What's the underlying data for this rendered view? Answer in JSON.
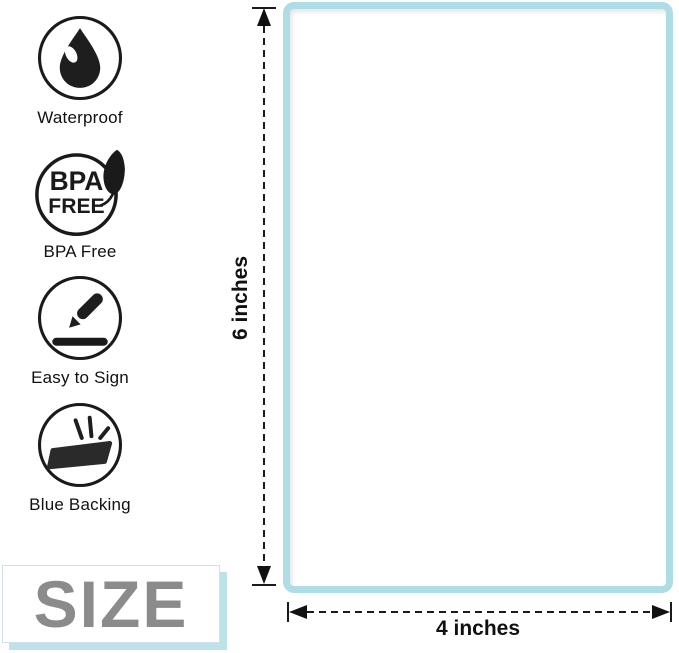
{
  "features": [
    {
      "label": "Waterproof",
      "icon": "water-drop-icon"
    },
    {
      "label": "BPA Free",
      "icon": "bpa-free-leaf-icon",
      "badge_line1": "BPA",
      "badge_line2": "FREE"
    },
    {
      "label": "Easy to Sign",
      "icon": "pencil-sign-icon"
    },
    {
      "label": "Blue Backing",
      "icon": "label-backing-icon"
    }
  ],
  "size_badge": {
    "label": "SIZE"
  },
  "diagram": {
    "height_label": "6 inches",
    "width_label": "4 inches"
  },
  "colors": {
    "label_border": "#b0dce5",
    "size_text": "#8b8b8b",
    "size_shadow": "#bfe1e8",
    "ink": "#1a1a1a"
  }
}
